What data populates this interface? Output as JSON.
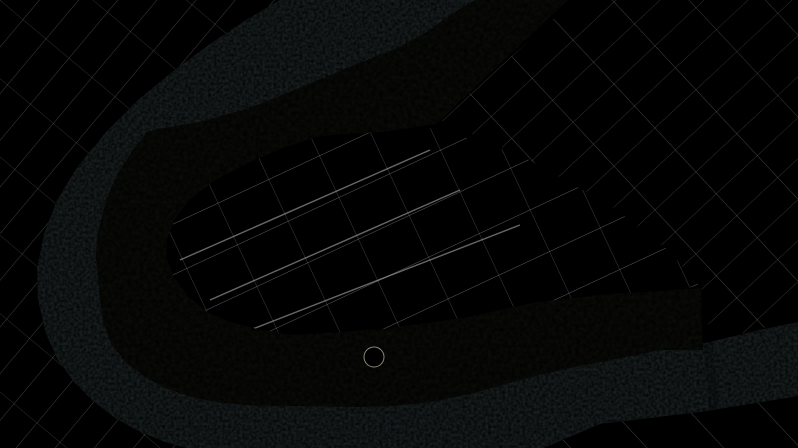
{
  "scene": {
    "title": "Riverbend wetland park masterplan aerial overlay",
    "type": "landscape-masterplan-aerial",
    "palette": {
      "base": "#dde1c3",
      "washWhite": "#ffffff",
      "grayWash": "#c7cbc4",
      "interiorTint": "#e9ebc5",
      "seTint": "#dfe4bd",
      "river": "#222d3c",
      "riverEdge": "#19222e",
      "band": "#a5c566",
      "bandLight": "#cde08b",
      "lawn": "#dbe9a0",
      "pond": "#aac3df",
      "pondEdge": "#7fa2c4",
      "channel": "#9db9d8",
      "lagoon": "#a7c0dc",
      "boundaryDash": "#b05a1e",
      "waterlineRed": "#a83325",
      "bankBrown": "#6f4526",
      "road": "#999d96",
      "roadFaint": "#b9bcb2",
      "bridge": "#c6c9c3",
      "villageRoof": "#b18273",
      "darkBuilding": "#7d7d72",
      "redStructure": "#6e1d16",
      "plaza": "#c9c3ae",
      "plazaCore": "#7f9a55",
      "gridLine": "#ffffff",
      "swirl": "#b7c2bf",
      "stripeField": "#b9a98e",
      "grayBuilding": "#b4b6b0"
    },
    "treePalette": [
      "#2d5529",
      "#3f6b31",
      "#548036",
      "#8fae4e"
    ],
    "features": [
      {
        "name": "river",
        "label": "River bend"
      },
      {
        "name": "park-band",
        "label": "Riparian wetland parkland"
      },
      {
        "name": "lagoon",
        "label": "Wetland lagoon"
      },
      {
        "name": "project-boundary",
        "label": "Dashed project boundary"
      },
      {
        "name": "highway",
        "label": "Highway"
      },
      {
        "name": "river-bridge",
        "label": "River bridge"
      },
      {
        "name": "park-access-road",
        "label": "Park access road"
      },
      {
        "name": "overlook-plaza",
        "label": "Circular overlook plaza"
      },
      {
        "name": "village",
        "label": "Village building clusters"
      },
      {
        "name": "farmland",
        "label": "Faded farmland parcels"
      }
    ]
  }
}
